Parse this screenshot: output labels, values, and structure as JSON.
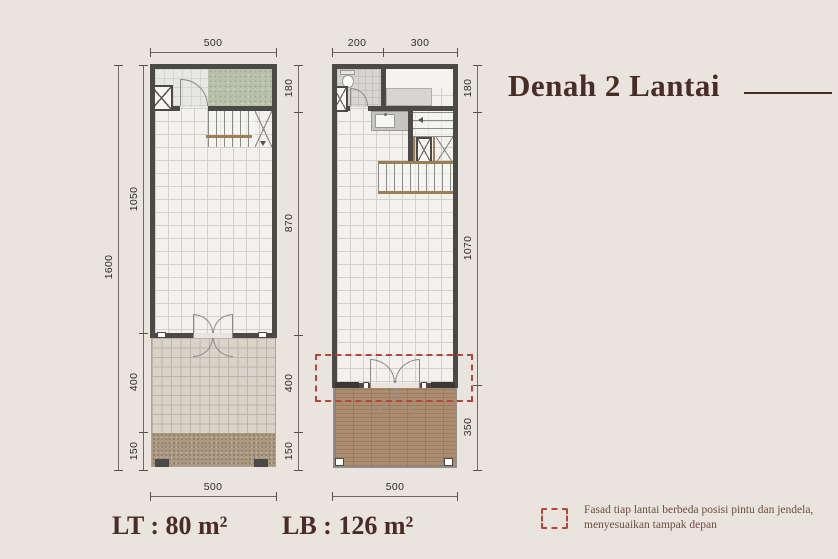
{
  "title": "Denah 2 Lantai",
  "area_labels": {
    "lt_prefix": "LT :",
    "lt_value": "80 m²",
    "lb_prefix": "LB :",
    "lb_value": "126 m²"
  },
  "legend": {
    "line1": "Fasad tiap lantai berbeda posisi pintu dan jendela,",
    "line2": "menyesuaikan tampak depan"
  },
  "dims": {
    "left_plan": {
      "top": "500",
      "bottom": "500",
      "outer_left": "1600",
      "inner_left": [
        "1050",
        "400",
        "150"
      ],
      "right": [
        "180",
        "870",
        "400",
        "150"
      ]
    },
    "right_plan": {
      "top": [
        "200",
        "300"
      ],
      "bottom": "500",
      "right": [
        "180",
        "1070",
        "350"
      ]
    }
  },
  "colors": {
    "background": "#e9e5de",
    "title_brown": "#4a2c26",
    "accent_red": "#b5463a",
    "wall_gray": "#4b4a47",
    "garden_green": "#b8c1ab",
    "wood_brown": "#ac8c6e"
  }
}
